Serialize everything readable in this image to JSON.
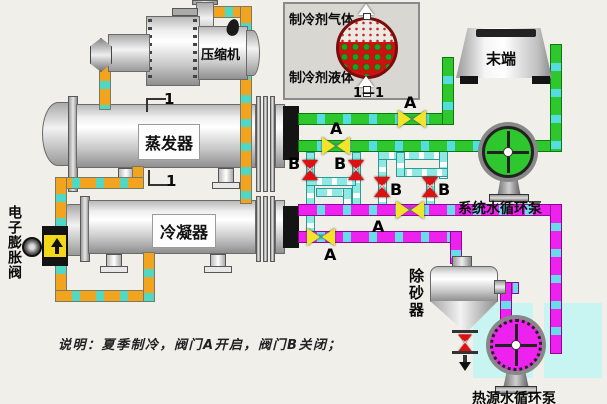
{
  "title": "水源热泵机组夏季制冷流程图",
  "inset": {
    "gas_label": "制冷剂气体",
    "liquid_label": "制冷剂液体",
    "section_label": "1—1"
  },
  "equipment": {
    "compressor": "压缩机",
    "evaporator": "蒸发器",
    "condenser": "冷凝器",
    "expansion_valve": "电子膨胀阀",
    "terminal": "末端",
    "system_pump": "系统水循环泵",
    "heat_source_pump": "热源水循环泵",
    "sand_remover": "除砂器"
  },
  "section_marks": {
    "top": "1",
    "bottom": "1"
  },
  "valves": {
    "a_labels": [
      "A",
      "A",
      "A",
      "A"
    ],
    "b_labels": [
      "B",
      "B",
      "B",
      "B"
    ]
  },
  "note": "说明：夏季制冷，阀门A开启，阀门B关闭；",
  "colors": {
    "background": "#f0efe9",
    "refrigerant_pipe": "#f2a41e",
    "chilled_water_pipe": "#2ec82e",
    "heat_water_pipe": "#ee22ee",
    "crossover_pipe": "#8ee9e2",
    "pipe_dash": "#55dce0",
    "valve_a": "#f2e428",
    "valve_b": "#dd1111",
    "tank": "#c8f4f2",
    "inset_liquid": "#cc1111",
    "inset_droplets": "#1fa11f"
  }
}
